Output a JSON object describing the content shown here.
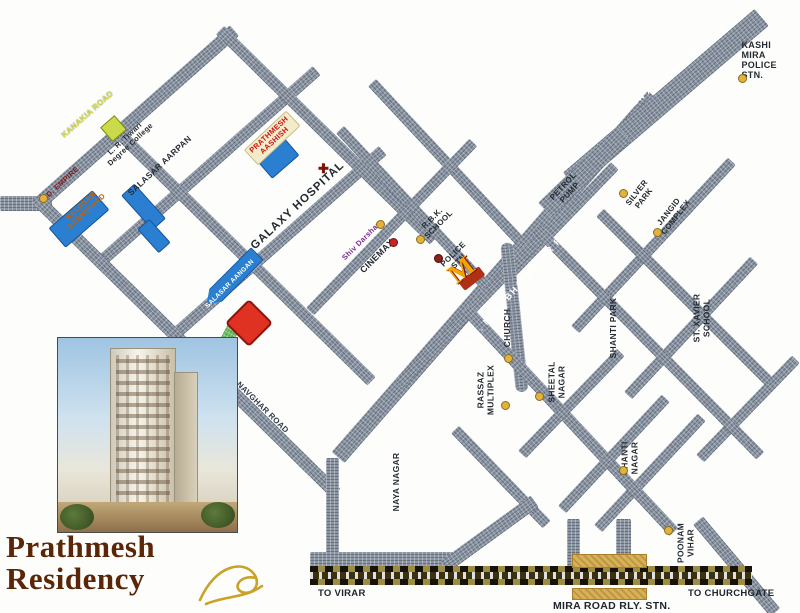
{
  "brand": {
    "line1": "Prathmesh",
    "line2": "Residency"
  },
  "railway": {
    "to_left": "TO VIRAR",
    "to_right": "TO CHURCHGATE",
    "station": "MIRA ROAD RLY. STN."
  },
  "map": {
    "road_labels": [
      {
        "id": "kanakia-road",
        "text": "KANAKIA ROAD"
      },
      {
        "id": "navghar-road",
        "text": "NAVGHAR ROAD"
      },
      {
        "id": "mira-bhayandar-road",
        "text": "45.6 M. MIRA BHAYANDAR ROAD"
      },
      {
        "id": "national-highway-8",
        "text": "NATIONAL HIGHWAY NO - 8"
      }
    ],
    "landmarks": [
      {
        "id": "kashi-mira-police",
        "text": "KASHI MIRA\nPOLICE STN."
      },
      {
        "id": "petrol-pump",
        "text": "PETROL\nPUMP"
      },
      {
        "id": "silver-park",
        "text": "SILVER\nPARK"
      },
      {
        "id": "jangid-complex",
        "text": "JANGID\nCOMPLEX"
      },
      {
        "id": "rbk-school",
        "text": "R.B.K.\nSCHOOL"
      },
      {
        "id": "police-stn",
        "text": "POLICE\nSTN."
      },
      {
        "id": "shiv-darshan",
        "text": "Shiv Darshan"
      },
      {
        "id": "cinemax",
        "text": "CINEMAX"
      },
      {
        "id": "church",
        "text": "CHURCH"
      },
      {
        "id": "sheetal-nagar",
        "text": "SHEETAL\nNAGAR"
      },
      {
        "id": "rassaz-multiplex",
        "text": "RASSAZ\nMULTIPLEX"
      },
      {
        "id": "naya-nagar",
        "text": "NAYA NAGAR"
      },
      {
        "id": "shanti-park",
        "text": "SHANTI PARK"
      },
      {
        "id": "st-xavier-school",
        "text": "ST. XAVIER\nSCHOOL"
      },
      {
        "id": "shanti-nagar",
        "text": "SHANTI\nNAGAR"
      },
      {
        "id": "poonam-vihar",
        "text": "POONAM\nVIHAR"
      },
      {
        "id": "kd-empire",
        "text": "K.D. EMPIRE"
      },
      {
        "id": "salasar-aashirwad",
        "text": "SALASAR\nAASHIRWAD"
      },
      {
        "id": "salasar-aarpan",
        "text": "SALASAR AARPAN"
      },
      {
        "id": "lr-tiwari-college",
        "text": "L. R. Tiwari\nDegree College"
      },
      {
        "id": "prathmesh-aashish",
        "text": "PRATHMESH\nAASHISH"
      },
      {
        "id": "galaxy-hospital",
        "text": "GALAXY HOSPITAL"
      },
      {
        "id": "salasar-aangan",
        "text": "SALASAR AANGAN"
      }
    ],
    "icons": [
      {
        "id": "mcdonalds-icon",
        "meaning": "McDonald's restaurant",
        "glyph": "M"
      },
      {
        "id": "hospital-cross-icon",
        "meaning": "hospital cross",
        "glyph": "✚"
      },
      {
        "id": "flourish-icon",
        "meaning": "decorative gold flourish"
      }
    ],
    "colors": {
      "road": "#8c96a4",
      "railway_dark": "#3a3110",
      "platform_gold": "#d9b054",
      "building_blue": "#2a7fd0",
      "site_red": "#e03222",
      "green_road": "#74c267",
      "logo_brown": "#5b2608",
      "accent_gold": "#c9a227"
    }
  }
}
